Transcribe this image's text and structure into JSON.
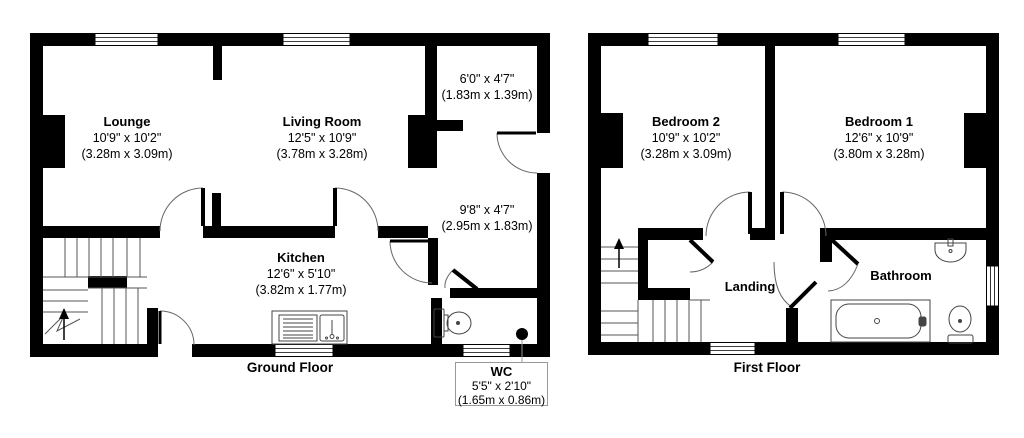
{
  "colors": {
    "wall": "#000000",
    "background": "#ffffff",
    "fixture_line": "#444444",
    "label_box_border": "#999999"
  },
  "floors": {
    "ground": {
      "caption": "Ground Floor",
      "rooms": {
        "lounge": {
          "name": "Lounge",
          "imperial": "10'9\" x 10'2\"",
          "metric": "(3.28m x 3.09m)"
        },
        "living_room": {
          "name": "Living Room",
          "imperial": "12'5\" x 10'9\"",
          "metric": "(3.78m x 3.28m)"
        },
        "entrance": {
          "imperial": "6'0\" x 4'7\"",
          "metric": "(1.83m x 1.39m)"
        },
        "hallway": {
          "imperial": "9'8\" x 4'7\"",
          "metric": "(2.95m x 1.83m)"
        },
        "kitchen": {
          "name": "Kitchen",
          "imperial": "12'6\" x 5'10\"",
          "metric": "(3.82m x 1.77m)"
        },
        "wc": {
          "name": "WC",
          "imperial": "5'5\" x 2'10\"",
          "metric": "(1.65m x 0.86m)"
        }
      }
    },
    "first": {
      "caption": "First Floor",
      "rooms": {
        "bedroom2": {
          "name": "Bedroom 2",
          "imperial": "10'9\" x 10'2\"",
          "metric": "(3.28m x 3.09m)"
        },
        "bedroom1": {
          "name": "Bedroom 1",
          "imperial": "12'6\" x 10'9\"",
          "metric": "(3.80m x 3.28m)"
        },
        "landing": {
          "name": "Landing"
        },
        "bathroom": {
          "name": "Bathroom"
        }
      }
    }
  }
}
